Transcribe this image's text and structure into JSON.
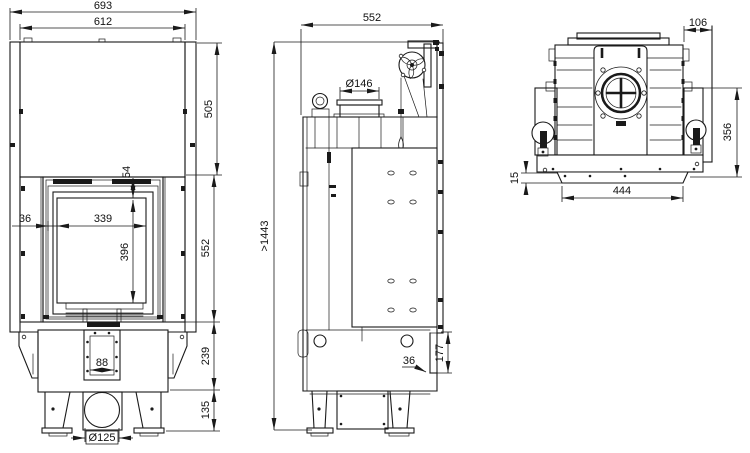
{
  "background": "#ffffff",
  "line_color": "#1a1a1a",
  "front_view": {
    "overall_width": "693",
    "body_width": "612",
    "hood_height": "505",
    "glass_top_inset": "54",
    "frame_side_inset": "36",
    "glass_width": "339",
    "glass_height": "396",
    "door_section_height": "552",
    "ashpan_slot_width": "88",
    "base_height": "239",
    "leg_height": "135",
    "air_inlet_diameter": "Ø125"
  },
  "side_view": {
    "depth": "552",
    "flue_collar_diameter": "Ø146",
    "min_total_height": ">1443",
    "rear_wall_offset": "36",
    "rear_outlet_height": "177"
  },
  "rear_view": {
    "rear_frame_offset": "106",
    "lower_section_height": "356",
    "base_plate_thickness": "15",
    "base_width": "444"
  }
}
